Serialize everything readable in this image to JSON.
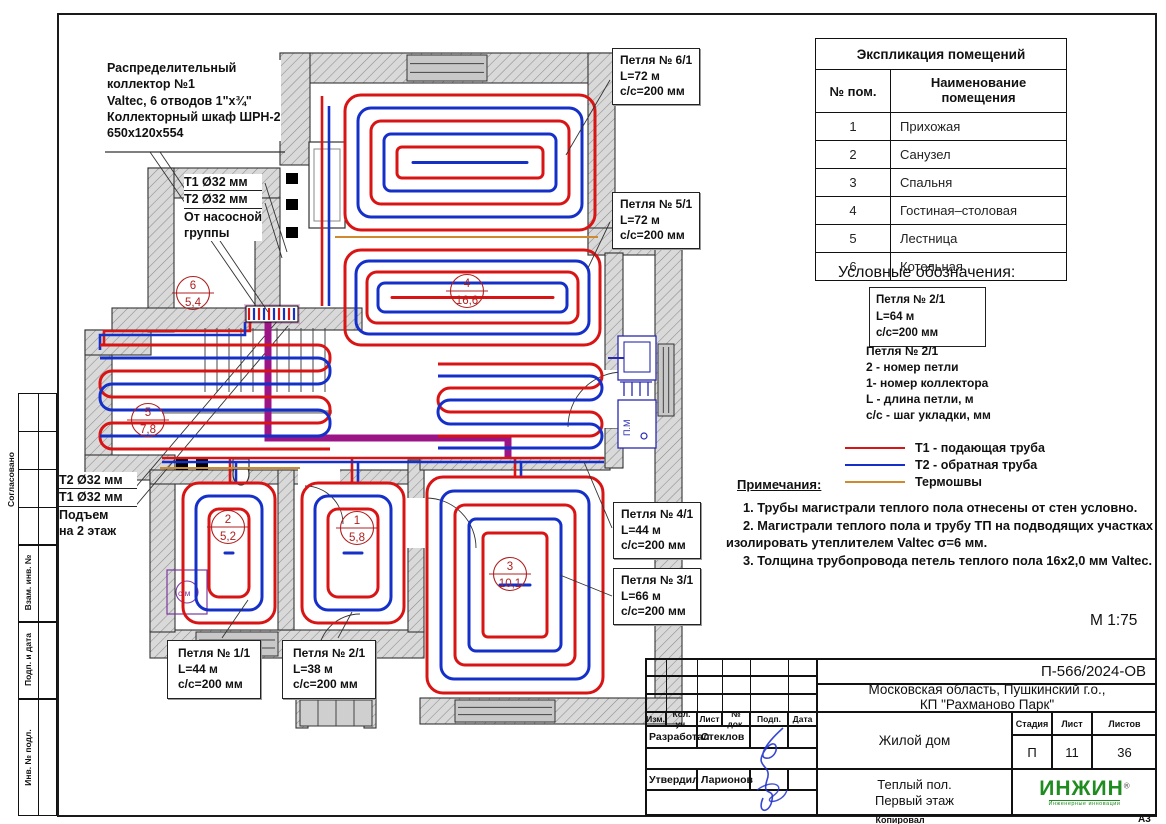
{
  "palette": {
    "supply": "#d81414",
    "return": "#1430c8",
    "thermal": "#cf8a30",
    "trunk": "#9c1586",
    "marker": "#b02020",
    "fixture": "#2a2ab0",
    "washer": "#7a3aa0",
    "logo_green": "#1f8c1f"
  },
  "rooms_table": {
    "title": "Экспликация помещений",
    "col1": "№ пом.",
    "col2": "Наименование\nпомещения",
    "rows": [
      [
        "1",
        "Прихожая"
      ],
      [
        "2",
        "Санузел"
      ],
      [
        "3",
        "Спальня"
      ],
      [
        "4",
        "Гостиная–столовая"
      ],
      [
        "5",
        "Лестница"
      ],
      [
        "6",
        "Котельная"
      ]
    ]
  },
  "legend": {
    "title": "Условные обозначения:",
    "sample_box": [
      "Петля № 2/1",
      "L=64 м",
      "с/с=200 мм"
    ],
    "description": "Петля № 2/1\n2 - номер петли\n1- номер коллектора\nL - длина петли, м\nс/с - шаг укладки, мм",
    "lines": [
      {
        "color": "#d81414",
        "label": "Т1 - подающая труба"
      },
      {
        "color": "#1430c8",
        "label": "Т2 - обратная труба"
      },
      {
        "color": "#cf8a30",
        "label": "Термошвы"
      }
    ]
  },
  "notes": {
    "title": "Примечания:",
    "items": [
      "1.   Трубы магистрали теплого пола отнесены от стен условно.",
      "2.   Магистрали теплого пола и трубу ТП на подводящих участках изолировать утеплителем Valtec σ=6 мм.",
      "3.   Толщина трубопровода петель теплого пола 16х2,0 мм Valtec."
    ]
  },
  "annotations": {
    "collector_note": "Распределительный\nколлектор №1\nValtec, 6 отводов 1\"х¾\"\nКоллекторный шкаф ШРН-2\n650х120х554",
    "t1": "Т1 Ø32 мм",
    "t2": "Т2 Ø32 мм",
    "from_pump": "От насосной\nгруппы",
    "riser_t2": "Т2 Ø32 мм",
    "riser_t1": "Т1 Ø32 мм",
    "riser_text": "Подъем\nна 2 этаж"
  },
  "loop_labels": [
    {
      "lines": [
        "Петля № 6/1",
        "L=72 м",
        "с/с=200 мм"
      ]
    },
    {
      "lines": [
        "Петля № 5/1",
        "L=72 м",
        "с/с=200 мм"
      ]
    },
    {
      "lines": [
        "Петля № 4/1",
        "L=44 м",
        "с/с=200 мм"
      ]
    },
    {
      "lines": [
        "Петля № 3/1",
        "L=66 м",
        "с/с=200 мм"
      ]
    },
    {
      "lines": [
        "Петля № 1/1",
        "L=44 м",
        "с/с=200 мм"
      ]
    },
    {
      "lines": [
        "Петля № 2/1",
        "L=38 м",
        "с/с=200 мм"
      ]
    }
  ],
  "room_markers": [
    {
      "num": "1",
      "area": "5,8"
    },
    {
      "num": "2",
      "area": "5,2"
    },
    {
      "num": "3",
      "area": "10,1"
    },
    {
      "num": "4",
      "area": "16,6"
    },
    {
      "num": "5",
      "area": "7,8"
    },
    {
      "num": "6",
      "area": "5,4"
    }
  ],
  "plan": {
    "washing": "с/м",
    "dishwasher": "П.М"
  },
  "sheet": {
    "code": "П-566/2024-ОВ",
    "location_line1": "Московская область, Пушкинский г.о.,",
    "location_line2": "КП \"Рахманово Парк\"",
    "object": "Жилой дом",
    "drawing_title": "Теплый пол.\nПервый этаж",
    "stage_label": "Стадия",
    "sheet_label": "Лист",
    "sheets_label": "Листов",
    "stage": "П",
    "sheet_no": "11",
    "sheets_total": "36",
    "scale": "М 1:75",
    "format": "А3",
    "copied_label": "Копировал",
    "developed_label": "Разработал",
    "developed_by": "Стеклов",
    "approved_label": "Утвердил",
    "approved_by": "Ларионов",
    "columns": [
      "Изм.",
      "Кол. уч.",
      "Лист",
      "№ док.",
      "Подп.",
      "Дата"
    ],
    "logo": "ИНЖИН",
    "logo_reg": "®",
    "logo_sub": "Инженерные инновации"
  },
  "side_strip": {
    "agreed": "Согласовано",
    "labels": [
      "Взам. инв. №",
      "Подп. и дата",
      "Инв. № подл."
    ]
  }
}
